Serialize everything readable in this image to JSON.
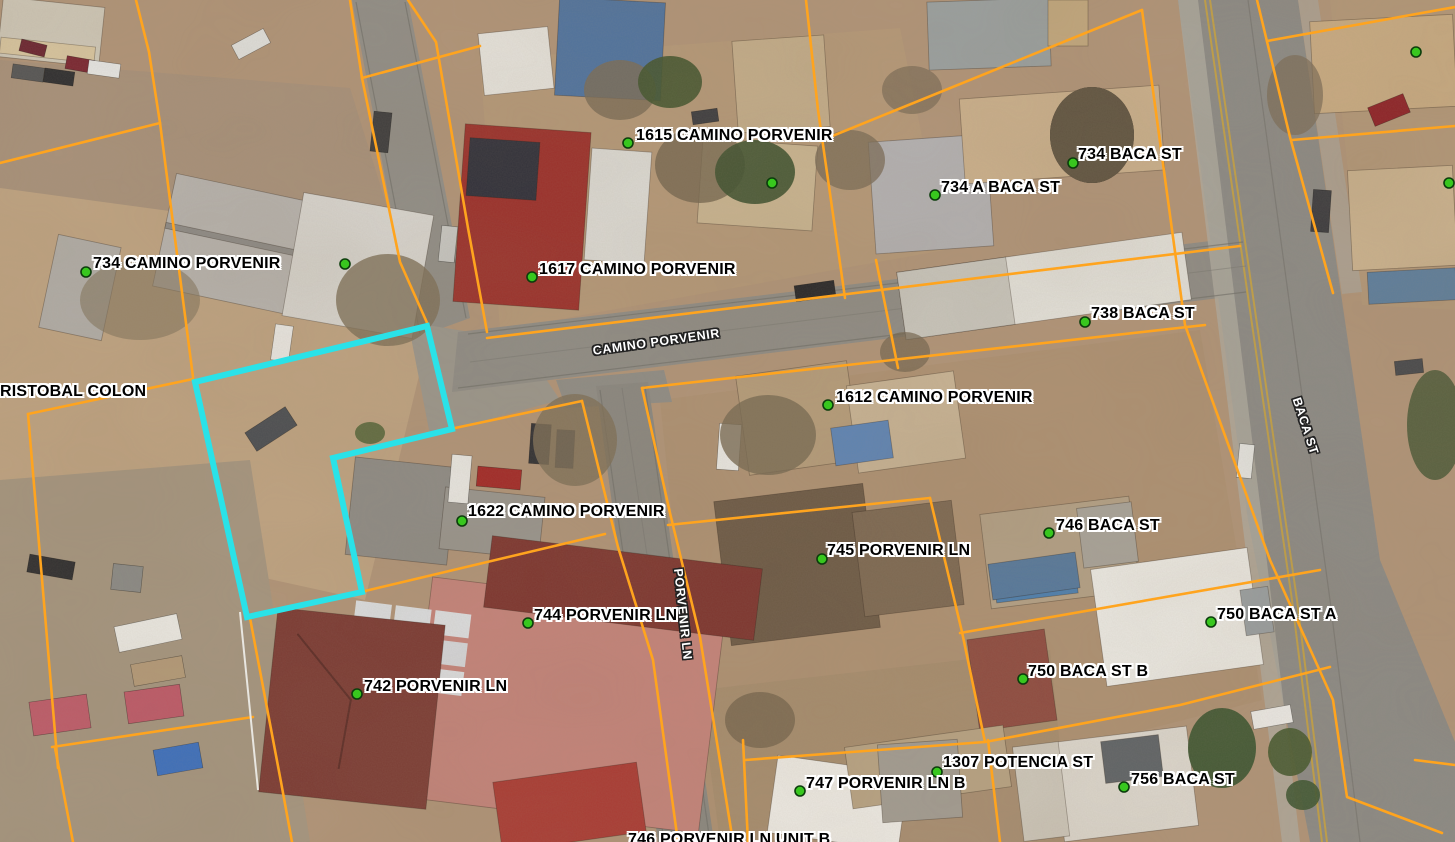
{
  "map": {
    "type": "aerial-parcel-gis-view",
    "highlight_color": "#2ae2e8",
    "parcel_line_color": "#ffa41e",
    "marker_color": "#38c71e"
  },
  "address_labels": [
    {
      "text": "1615 CAMINO PORVENIR"
    },
    {
      "text": "734 BACA ST"
    },
    {
      "text": "734 A BACA ST"
    },
    {
      "text": "734 CAMINO PORVENIR"
    },
    {
      "text": "1617 CAMINO PORVENIR"
    },
    {
      "text": "738 BACA ST"
    },
    {
      "text": "RISTOBAL COLON"
    },
    {
      "text": "1612 CAMINO PORVENIR"
    },
    {
      "text": "1622 CAMINO PORVENIR"
    },
    {
      "text": "746 BACA ST"
    },
    {
      "text": "745 PORVENIR LN"
    },
    {
      "text": "744 PORVENIR LN"
    },
    {
      "text": "750 BACA ST A"
    },
    {
      "text": "750 BACA ST B"
    },
    {
      "text": "742 PORVENIR LN"
    },
    {
      "text": "1307 POTENCIA ST"
    },
    {
      "text": "747 PORVENIR LN B"
    },
    {
      "text": "756 BACA ST"
    },
    {
      "text": "746 PORVENIR LN UNIT B"
    }
  ],
  "street_labels": [
    {
      "text": "CAMINO PORVENIR"
    },
    {
      "text": "PORVENIR LN"
    },
    {
      "text": "BACA ST"
    }
  ]
}
